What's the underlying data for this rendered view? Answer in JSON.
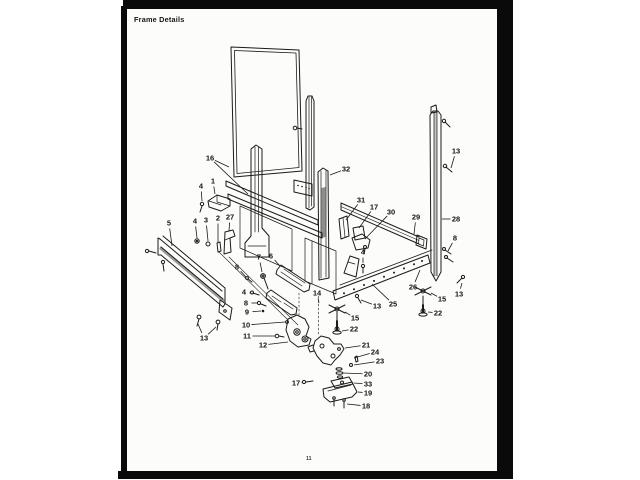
{
  "scan": {
    "title": "Frame Details",
    "page_number": "11",
    "border_color": "#0a0a0a",
    "paper_color": "#fcfcfb",
    "ink_color": "#1a1a1a"
  },
  "diagram": {
    "name": "frame-exploded-parts-diagram",
    "description": "Exploded isometric view of appliance frame assembly with numbered part callouts",
    "callouts": [
      {
        "t": "16",
        "x": 210,
        "y": 158,
        "l": [
          [
            229,
            167
          ],
          [
            248,
            194
          ]
        ]
      },
      {
        "t": "1",
        "x": 213,
        "y": 181,
        "l": [
          [
            215,
            194
          ]
        ]
      },
      {
        "t": "4",
        "x": 201,
        "y": 186,
        "l": [
          [
            202,
            201
          ]
        ]
      },
      {
        "t": "5",
        "x": 169,
        "y": 223,
        "l": [
          [
            172,
            246
          ]
        ]
      },
      {
        "t": "4",
        "x": 195,
        "y": 221,
        "l": [
          [
            197,
            238
          ]
        ]
      },
      {
        "t": "3",
        "x": 206,
        "y": 220,
        "l": [
          [
            208,
            241
          ]
        ]
      },
      {
        "t": "2",
        "x": 218,
        "y": 218,
        "l": [
          [
            218,
            242
          ]
        ]
      },
      {
        "t": "27",
        "x": 230,
        "y": 217,
        "l": [
          [
            229,
            231
          ]
        ]
      },
      {
        "t": "8",
        "x": 237,
        "y": 267,
        "l": [
          [
            246,
            277
          ]
        ]
      },
      {
        "t": "7",
        "x": 259,
        "y": 257,
        "l": [
          [
            262,
            272
          ]
        ]
      },
      {
        "t": "6",
        "x": 271,
        "y": 256,
        "l": [
          [
            280,
            266
          ]
        ]
      },
      {
        "t": "13",
        "x": 204,
        "y": 338,
        "l": [
          [
            198,
            324
          ],
          [
            216,
            327
          ]
        ]
      },
      {
        "t": "4",
        "x": 244,
        "y": 292,
        "l": [
          [
            251,
            293
          ]
        ]
      },
      {
        "t": "8",
        "x": 246,
        "y": 303,
        "l": [
          [
            257,
            303
          ]
        ]
      },
      {
        "t": "9",
        "x": 247,
        "y": 312,
        "l": [
          [
            261,
            311
          ]
        ]
      },
      {
        "t": "10",
        "x": 246,
        "y": 325,
        "l": [
          [
            285,
            322
          ]
        ]
      },
      {
        "t": "11",
        "x": 247,
        "y": 336,
        "l": [
          [
            275,
            336
          ]
        ]
      },
      {
        "t": "12",
        "x": 263,
        "y": 345,
        "l": [
          [
            288,
            342
          ]
        ]
      },
      {
        "t": "14",
        "x": 317,
        "y": 293,
        "l": [
          [
            319,
            303
          ]
        ]
      },
      {
        "t": "13",
        "x": 377,
        "y": 306,
        "l": [
          [
            361,
            300
          ]
        ]
      },
      {
        "t": "25",
        "x": 393,
        "y": 304,
        "l": [
          [
            372,
            284
          ]
        ]
      },
      {
        "t": "15",
        "x": 355,
        "y": 318,
        "l": [
          [
            345,
            312
          ]
        ]
      },
      {
        "t": "22",
        "x": 354,
        "y": 329,
        "l": [
          [
            342,
            331
          ]
        ]
      },
      {
        "t": "21",
        "x": 366,
        "y": 345,
        "l": [
          [
            345,
            348
          ]
        ]
      },
      {
        "t": "24",
        "x": 375,
        "y": 352,
        "l": [
          [
            354,
            358
          ]
        ]
      },
      {
        "t": "23",
        "x": 380,
        "y": 361,
        "l": [
          [
            354,
            365
          ]
        ]
      },
      {
        "t": "20",
        "x": 368,
        "y": 374,
        "l": [
          [
            343,
            373
          ]
        ]
      },
      {
        "t": "33",
        "x": 368,
        "y": 384,
        "l": [
          [
            354,
            383
          ]
        ]
      },
      {
        "t": "19",
        "x": 368,
        "y": 393,
        "l": [
          [
            358,
            392
          ]
        ]
      },
      {
        "t": "18",
        "x": 366,
        "y": 406,
        "l": [
          [
            347,
            404
          ]
        ]
      },
      {
        "t": "17",
        "x": 296,
        "y": 383,
        "l": [
          [
            303,
            382
          ]
        ]
      },
      {
        "t": "4",
        "x": 363,
        "y": 252,
        "l": [
          [
            363,
            263
          ]
        ]
      },
      {
        "t": "32",
        "x": 346,
        "y": 169,
        "l": [
          [
            330,
            175
          ]
        ]
      },
      {
        "t": "31",
        "x": 361,
        "y": 200,
        "l": [
          [
            346,
            220
          ]
        ]
      },
      {
        "t": "17",
        "x": 374,
        "y": 207,
        "l": [
          [
            359,
            228
          ]
        ]
      },
      {
        "t": "30",
        "x": 391,
        "y": 212,
        "l": [
          [
            365,
            239
          ]
        ]
      },
      {
        "t": "29",
        "x": 416,
        "y": 217,
        "l": [
          [
            414,
            234
          ]
        ]
      },
      {
        "t": "13",
        "x": 456,
        "y": 151,
        "l": [
          [
            451,
            168
          ]
        ]
      },
      {
        "t": "28",
        "x": 456,
        "y": 219,
        "l": [
          [
            442,
            219
          ]
        ]
      },
      {
        "t": "8",
        "x": 455,
        "y": 238,
        "l": [
          [
            448,
            251
          ]
        ]
      },
      {
        "t": "26",
        "x": 413,
        "y": 287,
        "l": [
          [
            420,
            270
          ]
        ]
      },
      {
        "t": "15",
        "x": 442,
        "y": 299,
        "l": [
          [
            431,
            293
          ]
        ]
      },
      {
        "t": "13",
        "x": 459,
        "y": 294,
        "l": [
          [
            462,
            283
          ]
        ]
      },
      {
        "t": "22",
        "x": 438,
        "y": 313,
        "l": [
          [
            428,
            312
          ]
        ]
      }
    ]
  }
}
